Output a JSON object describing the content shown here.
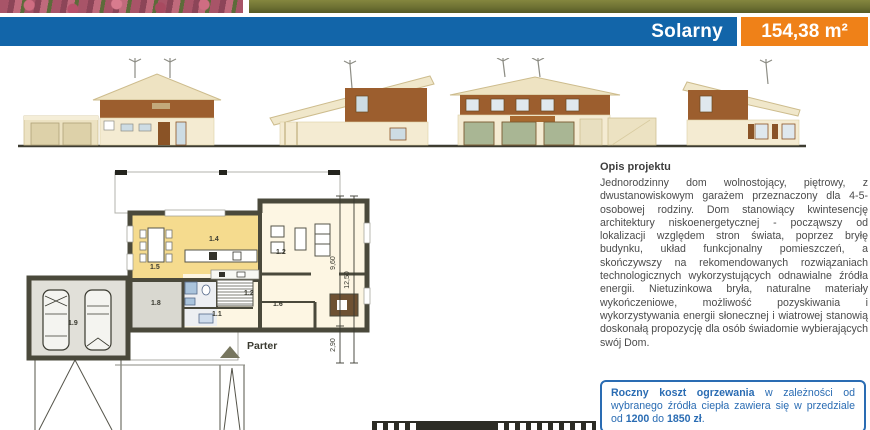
{
  "header": {
    "project_name": "Solarny",
    "area_label": "154,38 m²",
    "accent_blue": "#1265a9",
    "accent_orange": "#ef8118"
  },
  "floor_plan": {
    "floor_label": "Parter",
    "rooms": {
      "garage": "1.9",
      "mudroom": "1.8",
      "dining": "1.5",
      "kitchen": "1.4",
      "living_room": "1.2",
      "corridor": "1.2",
      "utility": "1.6",
      "hall": "1.1"
    },
    "dimensions": {
      "depth_main": "9,60",
      "depth_porch": "2,90",
      "depth_total": "12,50"
    }
  },
  "description": {
    "heading": "Opis projektu",
    "body": "Jednorodzinny dom wolnostojący, piętrowy, z dwustanowiskowym garażem przeznaczony dla 4-5-osobowej rodziny. Dom stanowiący kwintesencję architektury niskoenergetycznej - począwszy od lokalizacji względem stron świata, poprzez bryłę budynku, układ funkcjonalny pomieszczeń, a skończywszy na rekomendowanych rozwiązaniach technologicznych wykorzystujących odnawialne źródła energii. Nietuzinkowa bryła, naturalne materiały wykończeniowe, możliwość pozyskiwania i wykorzystywania energii słonecznej i wiatrowej stanowią doskonałą propozycję dla osób świadomie wybierających swój Dom."
  },
  "info_box": {
    "bold_intro": "Roczny koszt ogrzewania",
    "text_mid": " w zależności od wybranego źródła ciepła zawiera się w przedziale od ",
    "bold_min": "1200",
    "text_to": " do ",
    "bold_max": "1850 zł",
    "text_end": ".",
    "border_color": "#2a6cb3"
  }
}
